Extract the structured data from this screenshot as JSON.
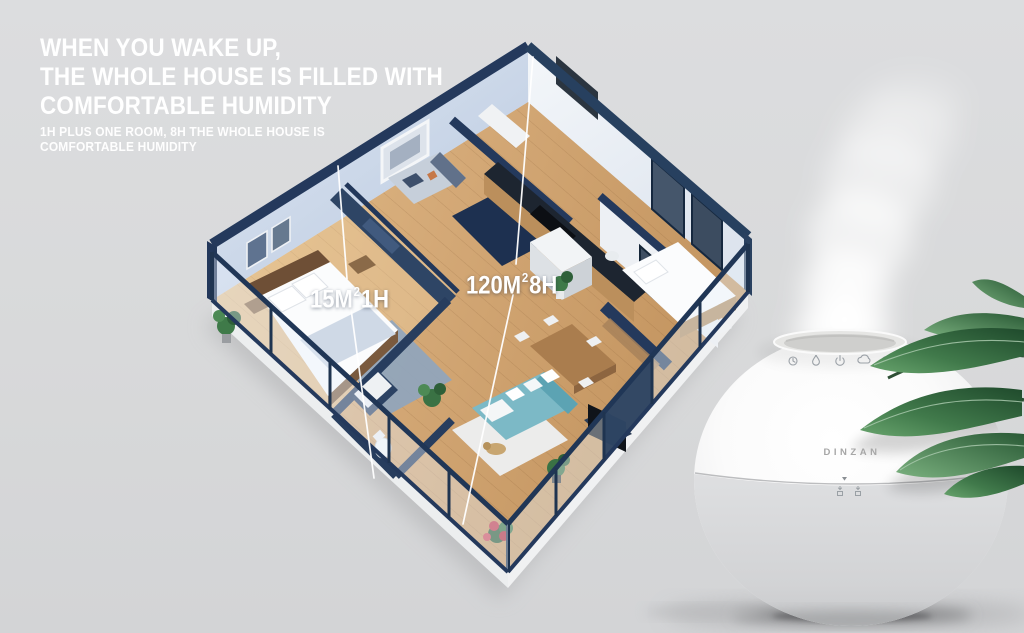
{
  "headline": {
    "line1": "WHEN YOU WAKE UP,",
    "line2": "THE WHOLE HOUSE IS FILLED WITH",
    "line3": "COMFORTABLE HUMIDITY"
  },
  "subheadline": {
    "line1": "1H PLUS ONE ROOM, 8H THE WHOLE HOUSE IS",
    "line2": "COMFORTABLE HUMIDITY"
  },
  "floorplan": {
    "label_single_room": {
      "area": "15M",
      "sup": "2",
      "time": "1H"
    },
    "label_whole_house": {
      "area": "120M",
      "sup": "2",
      "time": "8H"
    }
  },
  "product": {
    "brand": "DINZAN",
    "control_icons": [
      "timer-icon",
      "water-drop-icon",
      "power-icon",
      "mist-icon",
      "night-light-icon"
    ]
  },
  "colors": {
    "background": "#d9dadb",
    "wall_navy": "#27405f",
    "wood_floor": "#cfa06a",
    "sofa_teal": "#7cb9c6",
    "headline_text": "#ffffff"
  }
}
